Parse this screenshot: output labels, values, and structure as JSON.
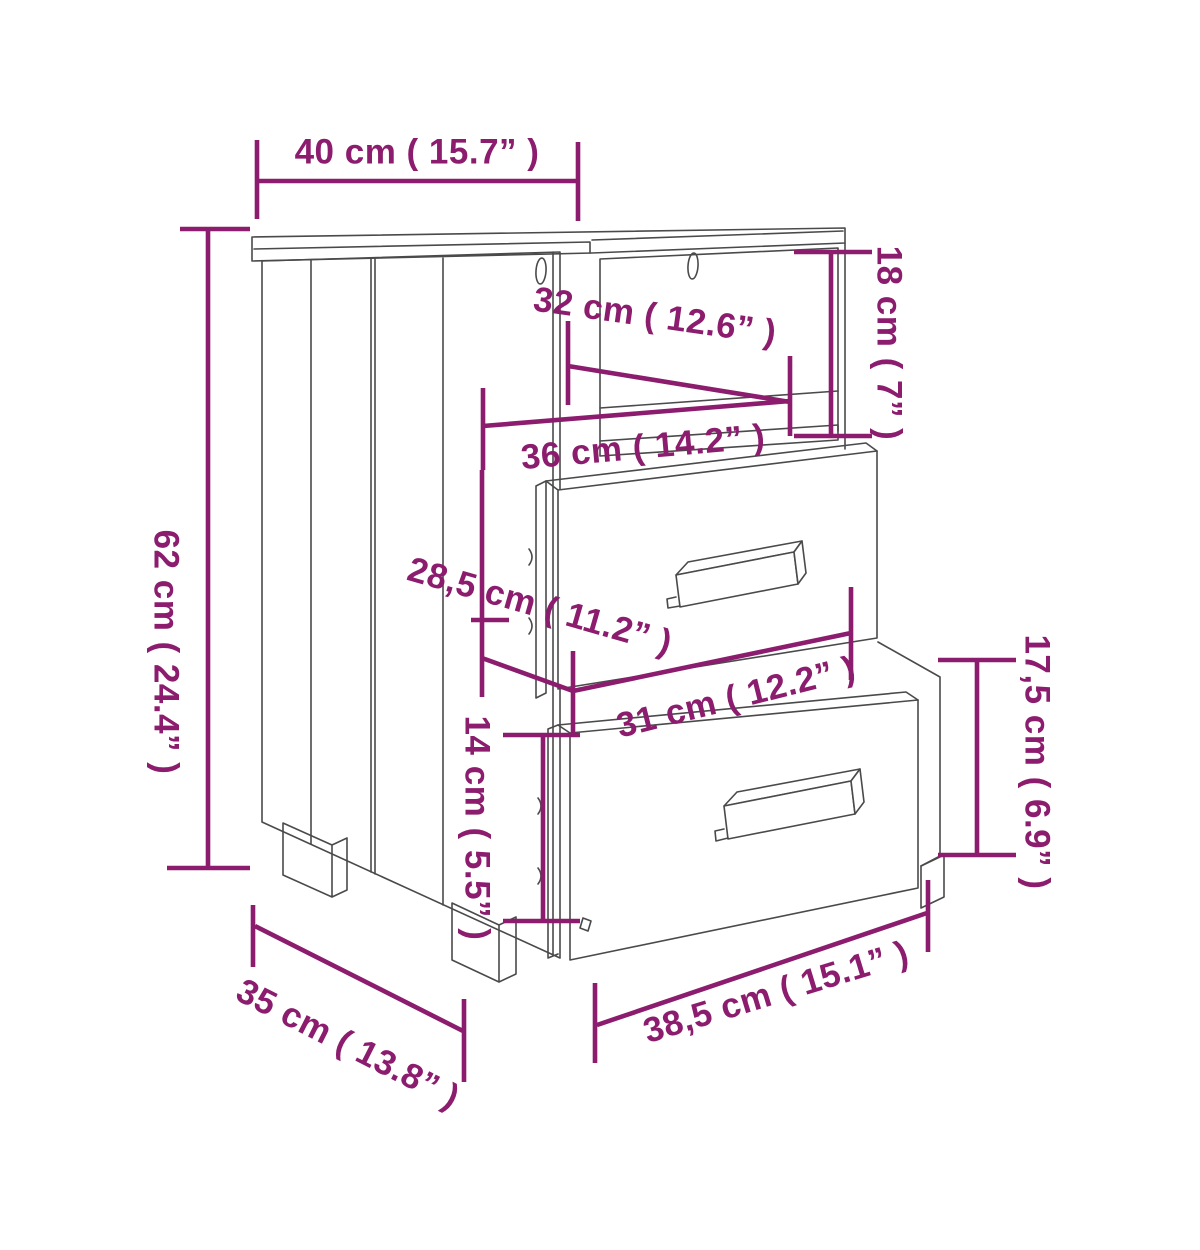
{
  "diagram": {
    "title": "Bedside cabinet dimension drawing",
    "subject": "bedside-cabinet-with-two-drawers-and-open-shelf",
    "style": {
      "line_color": "#4a4a4a",
      "dimension_color": "#8b1c6e",
      "background_color": "#ffffff"
    },
    "unit_primary": "cm",
    "unit_secondary": "inch",
    "dimensions": [
      {
        "id": "top-width",
        "cm": "40",
        "inch": "15.7",
        "label": "40 cm ( 15.7” )"
      },
      {
        "id": "niche-height",
        "cm": "18",
        "inch": "7",
        "label": "18 cm ( 7” )"
      },
      {
        "id": "niche-width",
        "cm": "32",
        "inch": "12.6",
        "label": "32 cm ( 12.6” )"
      },
      {
        "id": "shelf-width",
        "cm": "36",
        "inch": "14.2",
        "label": "36 cm ( 14.2” )"
      },
      {
        "id": "overall-height",
        "cm": "62",
        "inch": "24.4",
        "label": "62 cm ( 24.4” )"
      },
      {
        "id": "drawer-section-depth",
        "cm": "28,5",
        "inch": "11.2",
        "label": "28,5 cm ( 11.2” )"
      },
      {
        "id": "leg-height",
        "cm": "14",
        "inch": "5.5",
        "label": "14 cm ( 5.5” )"
      },
      {
        "id": "drawer-width",
        "cm": "31",
        "inch": "12.2",
        "label": "31 cm ( 12.2” )"
      },
      {
        "id": "drawer-front-height",
        "cm": "17,5",
        "inch": "6.9",
        "label": "17,5 cm ( 6.9” )"
      },
      {
        "id": "depth",
        "cm": "35",
        "inch": "13.8",
        "label": "35 cm ( 13.8” )"
      },
      {
        "id": "front-width",
        "cm": "38,5",
        "inch": "15.1",
        "label": "38,5 cm ( 15.1” )"
      }
    ]
  }
}
